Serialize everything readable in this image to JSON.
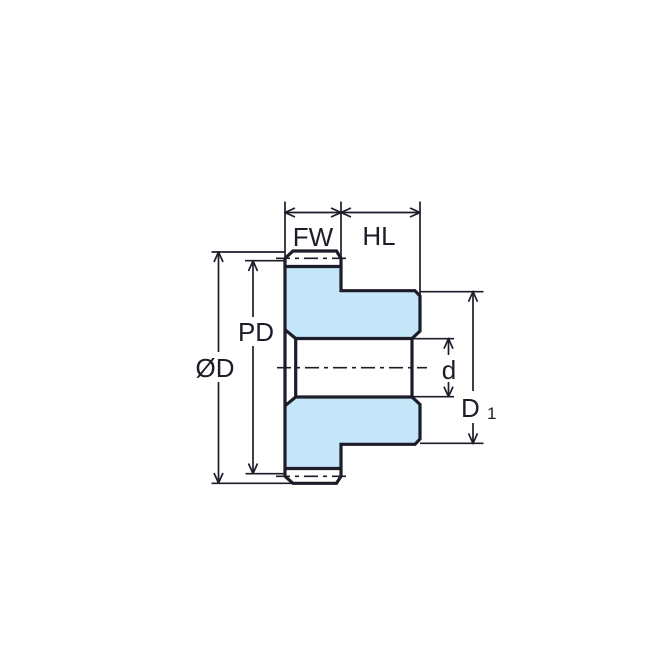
{
  "colors": {
    "fill": "#C4E6F8",
    "line": "#1C1D28",
    "background": "#FFFFFF"
  },
  "labels": {
    "fw": "FW",
    "hl": "HL",
    "pd": "PD",
    "od": "ØD",
    "d": "d",
    "d1_main": "D",
    "d1_sub": "1"
  }
}
